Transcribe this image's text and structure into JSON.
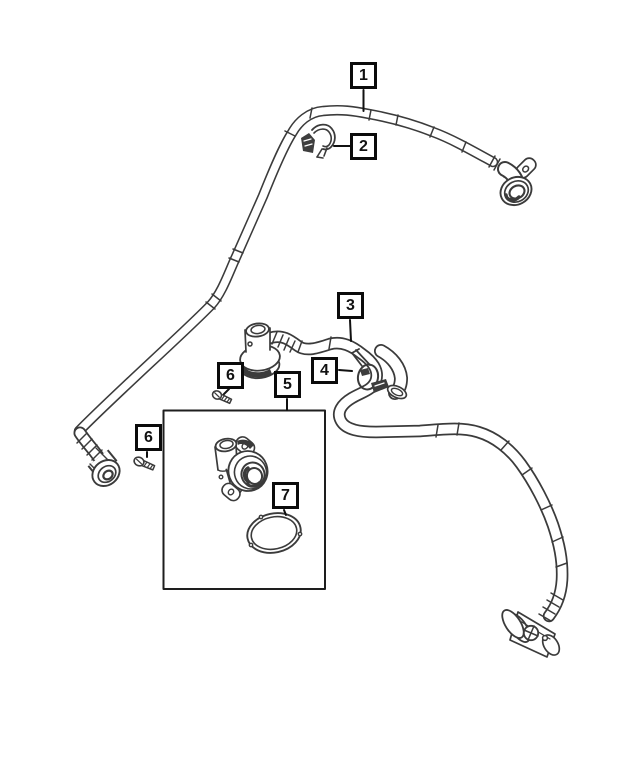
{
  "diagram": {
    "background_color": "#ffffff",
    "line_color": "#3b3b3b",
    "callout_border_color": "#0b0b0b",
    "callouts": [
      {
        "label": "1",
        "part": "vapor-tube-assembly"
      },
      {
        "label": "2",
        "part": "retaining-clip"
      },
      {
        "label": "3",
        "part": "vent-hose-assembly"
      },
      {
        "label": "4",
        "part": "hose-clamp"
      },
      {
        "label": "5",
        "part": "vent-valve"
      },
      {
        "label": "6",
        "part": "screw-upper"
      },
      {
        "label": "6",
        "part": "screw-left"
      },
      {
        "label": "7",
        "part": "seal-o-ring"
      }
    ]
  }
}
